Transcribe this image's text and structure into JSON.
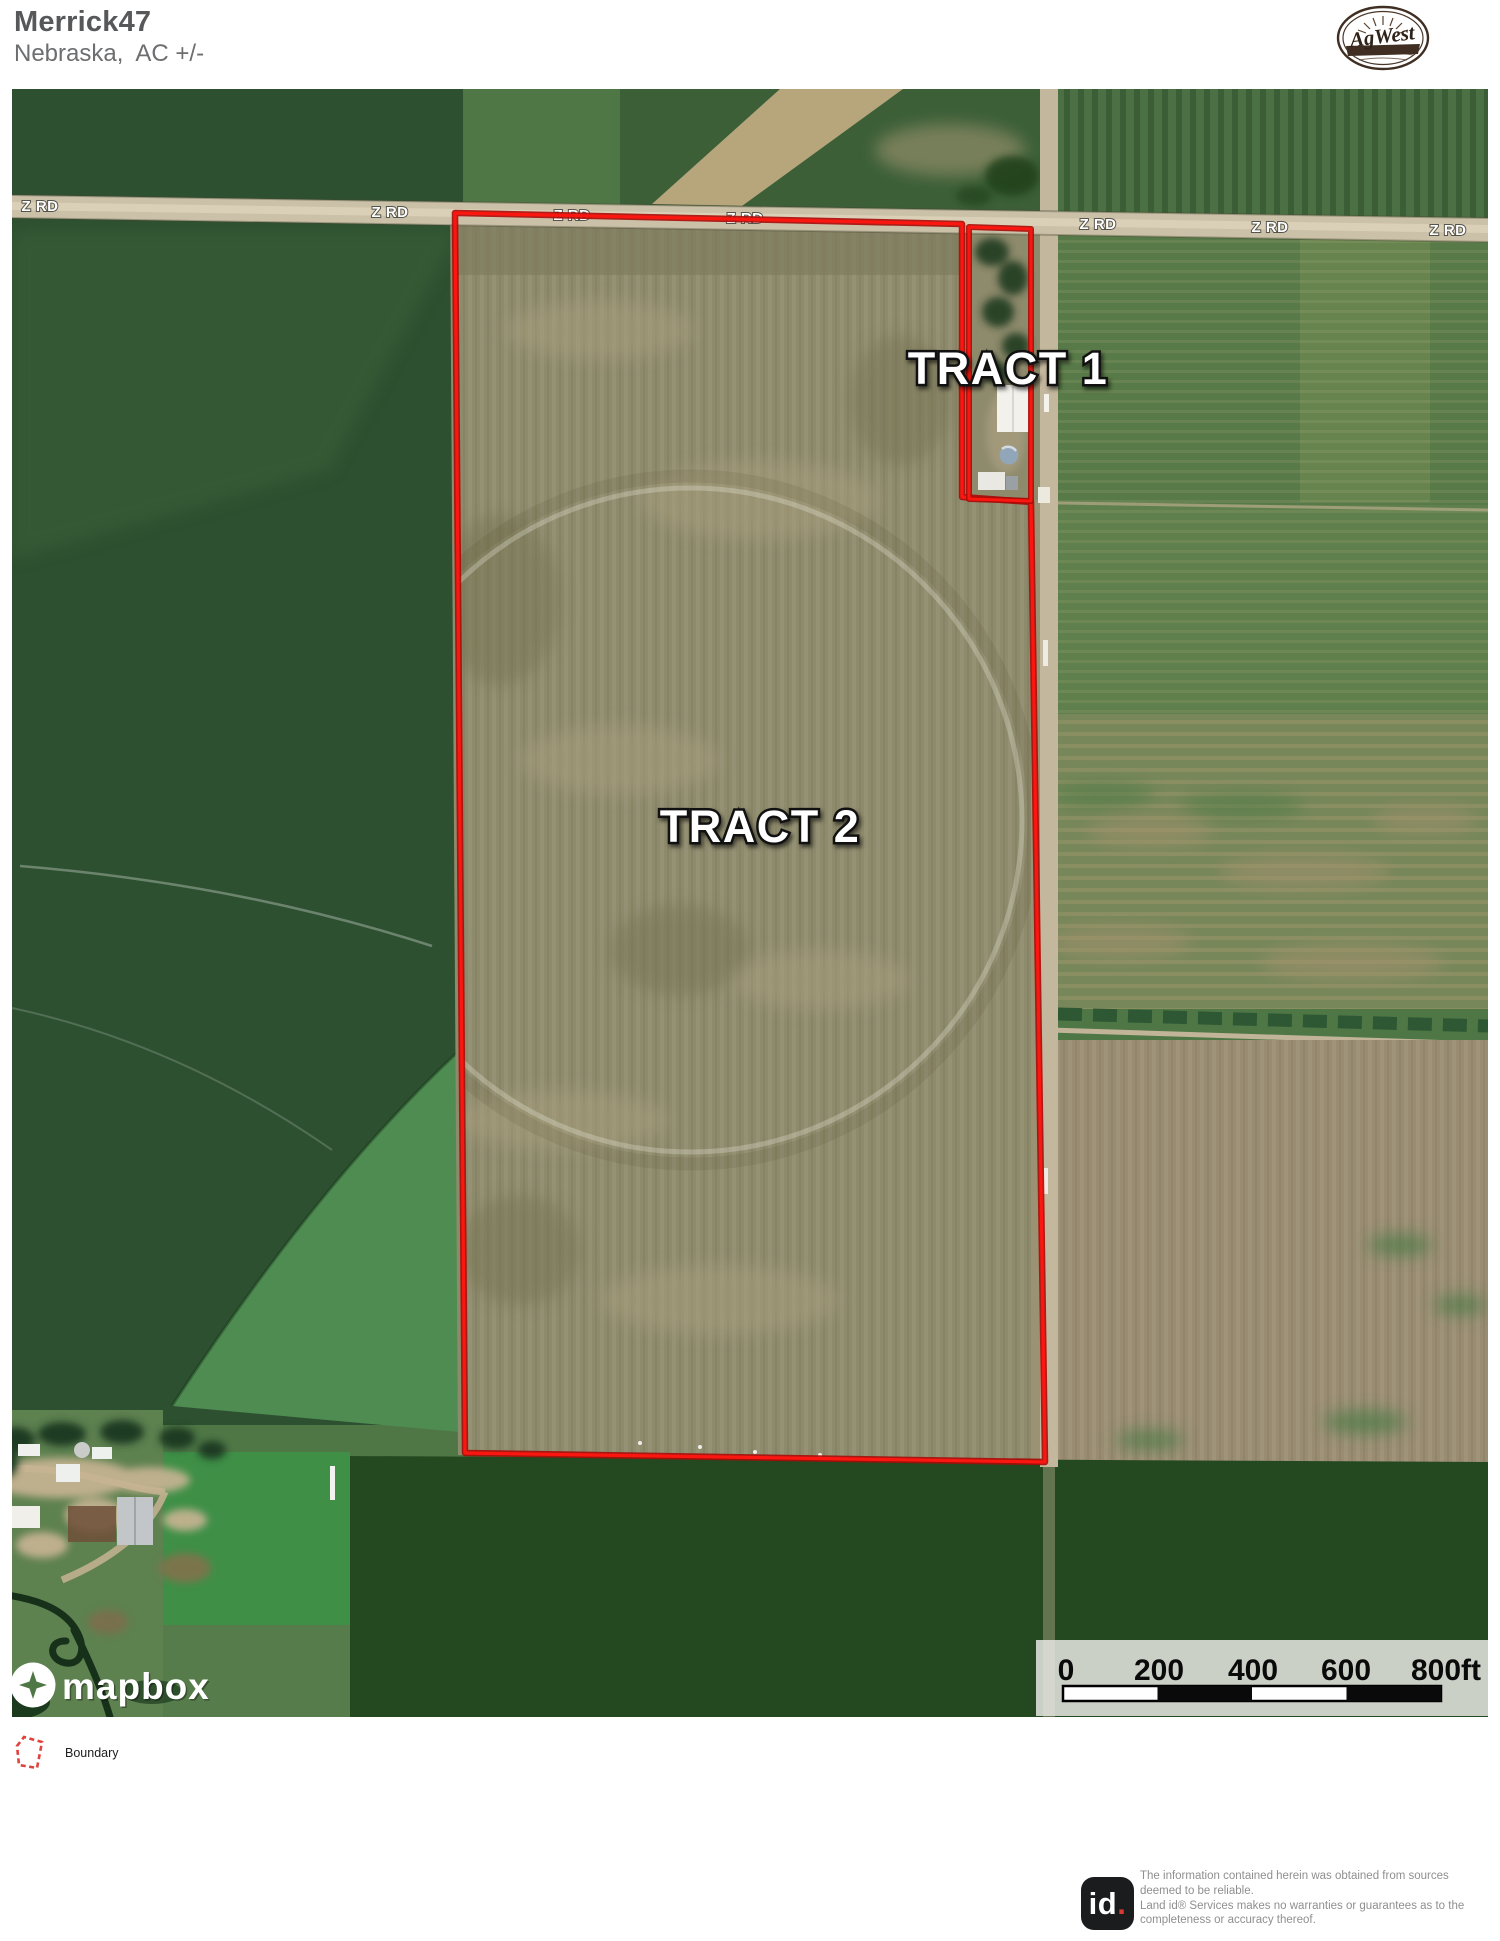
{
  "header": {
    "title": "Merrick47",
    "subtitle": "Nebraska,  AC +/-"
  },
  "brand": {
    "name": "AgWest"
  },
  "map": {
    "road_label": "Z RD",
    "tract1_label": "TRACT 1",
    "tract2_label": "TRACT 2",
    "scale": {
      "ticks": [
        "0",
        "200",
        "400",
        "600",
        "800ft"
      ]
    },
    "attribution": "mapbox"
  },
  "legend": {
    "boundary": "Boundary"
  },
  "footer": {
    "logo": "id",
    "dot": ".",
    "lines": [
      "The information contained herein was obtained from sources",
      "deemed to be reliable.",
      " Land id® Services makes no warranties or guarantees as to the",
      "completeness or accuracy thereof."
    ]
  },
  "colors": {
    "boundary_red": "#F81710",
    "road_tan": "#CBC0A8",
    "header_gray": "#58595B",
    "scale_text": "#000000"
  }
}
